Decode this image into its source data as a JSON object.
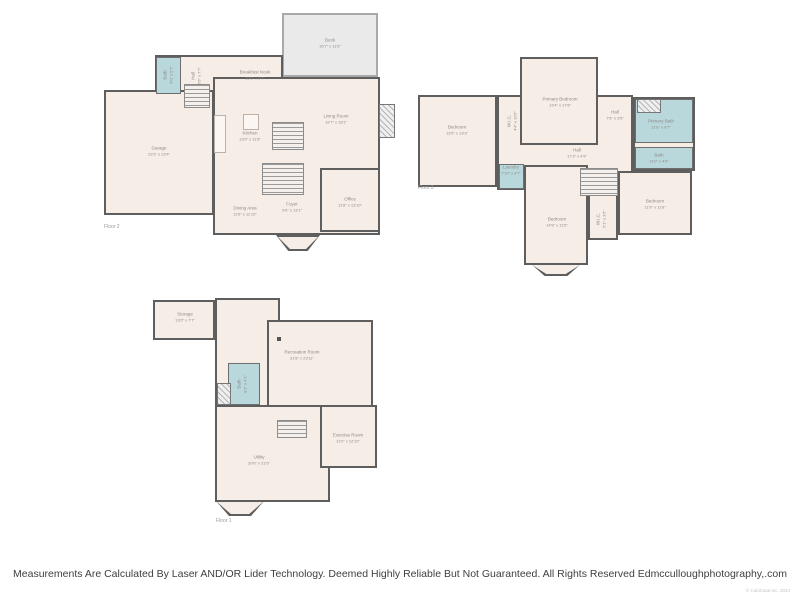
{
  "footer": {
    "disclaimer": "Measurements Are Calculated By Laser AND/OR Lider Technology. Deemed Highly Reliable But Not Guaranteed. All Rights Reserved Edmcculloughphotography,.com",
    "copyright": "© CubiCasa Inc, 2024"
  },
  "colors": {
    "room_fill": "#f7ede7",
    "deck_fill": "#eaeaea",
    "wet_room_fill": "#b9d8dc",
    "wall": "#5e5e5e",
    "label_text": "#8e8a87"
  },
  "floors": [
    {
      "id": "floor-2",
      "floor_label": "Floor 2",
      "floor_label_pos": {
        "x": 104,
        "y": 224
      },
      "shapes": [
        {
          "kind": "deck",
          "name": "deck-area",
          "x": 282,
          "y": 13,
          "w": 96,
          "h": 64
        },
        {
          "kind": "room",
          "name": "breakfast-hall-block",
          "x": 155,
          "y": 55,
          "w": 128,
          "h": 48
        },
        {
          "kind": "room",
          "name": "main-living-block",
          "x": 213,
          "y": 77,
          "w": 167,
          "h": 158
        },
        {
          "kind": "room",
          "name": "garage-room",
          "x": 104,
          "y": 90,
          "w": 110,
          "h": 125
        },
        {
          "kind": "wet",
          "name": "bath-room",
          "x": 156,
          "y": 57,
          "w": 25,
          "h": 37
        },
        {
          "kind": "room",
          "name": "office-room",
          "x": 320,
          "y": 168,
          "w": 60,
          "h": 64
        },
        {
          "kind": "hatch",
          "name": "fireplace",
          "x": 379,
          "y": 104,
          "w": 16,
          "h": 34
        },
        {
          "kind": "counter",
          "name": "kitchen-counter",
          "x": 214,
          "y": 115,
          "w": 12,
          "h": 38
        },
        {
          "kind": "counter",
          "name": "kitchen-island",
          "x": 243,
          "y": 114,
          "w": 16,
          "h": 16
        },
        {
          "kind": "stairs",
          "name": "stairs-upper",
          "x": 272,
          "y": 122,
          "w": 32,
          "h": 28
        },
        {
          "kind": "stairs",
          "name": "stairs-lower",
          "x": 262,
          "y": 163,
          "w": 42,
          "h": 32
        },
        {
          "kind": "stairs",
          "name": "entry-steps",
          "x": 184,
          "y": 84,
          "w": 26,
          "h": 24
        },
        {
          "kind": "bay",
          "name": "foyer-bay-window",
          "x": 276,
          "y": 235,
          "w": 44,
          "h": 16
        }
      ],
      "labels": [
        {
          "name": "deck",
          "text": "Deck",
          "dims": "16'7\" x 11'9\"",
          "x": 330,
          "y": 43,
          "vertical": false
        },
        {
          "name": "breakfast-nook",
          "text": "Breakfast Nook",
          "dims": "10'8\" x 9'7\"",
          "x": 255,
          "y": 75,
          "vertical": false
        },
        {
          "name": "living-room",
          "text": "Living Room",
          "dims": "19'7\" x 18'1\"",
          "x": 336,
          "y": 119,
          "vertical": false
        },
        {
          "name": "kitchen",
          "text": "Kitchen",
          "dims": "13'0\" x 11'8\"",
          "x": 250,
          "y": 136,
          "vertical": false
        },
        {
          "name": "garage",
          "text": "Garage",
          "dims": "23'3\" x 23'4\"",
          "x": 159,
          "y": 151,
          "vertical": false
        },
        {
          "name": "bath-f2",
          "text": "Bath",
          "dims": "6'0\" x 5'7\"",
          "x": 168,
          "y": 75,
          "vertical": true
        },
        {
          "name": "hall-f2",
          "text": "Hall",
          "dims": "3'6\" x 7'7\"",
          "x": 196,
          "y": 76,
          "vertical": true
        },
        {
          "name": "dining-area",
          "text": "Dining Area",
          "dims": "11'6\" x 11'10\"",
          "x": 245,
          "y": 211,
          "vertical": false
        },
        {
          "name": "foyer",
          "text": "Foyer",
          "dims": "9'6\" x 13'1\"",
          "x": 292,
          "y": 207,
          "vertical": false
        },
        {
          "name": "office",
          "text": "Office",
          "dims": "11'8\" x 13'10\"",
          "x": 350,
          "y": 202,
          "vertical": false
        }
      ]
    },
    {
      "id": "floor-3",
      "floor_label": "Floor 3",
      "floor_label_pos": {
        "x": 418,
        "y": 185
      },
      "shapes": [
        {
          "kind": "room",
          "name": "bedroom-left-room",
          "x": 418,
          "y": 95,
          "w": 79,
          "h": 92
        },
        {
          "kind": "room",
          "name": "center-hall-block",
          "x": 497,
          "y": 95,
          "w": 136,
          "h": 95
        },
        {
          "kind": "room",
          "name": "primary-bedroom-room",
          "x": 520,
          "y": 57,
          "w": 78,
          "h": 88
        },
        {
          "kind": "room",
          "name": "bath-block",
          "x": 633,
          "y": 97,
          "w": 62,
          "h": 74
        },
        {
          "kind": "room",
          "name": "bedroom-right-room",
          "x": 618,
          "y": 171,
          "w": 74,
          "h": 64
        },
        {
          "kind": "room",
          "name": "bedroom-bottom-room",
          "x": 524,
          "y": 165,
          "w": 64,
          "h": 100
        },
        {
          "kind": "room",
          "name": "wic-bottom-room",
          "x": 588,
          "y": 190,
          "w": 30,
          "h": 50
        },
        {
          "kind": "wet",
          "name": "primary-bath-room",
          "x": 635,
          "y": 99,
          "w": 58,
          "h": 44
        },
        {
          "kind": "wet",
          "name": "bath-room-f3",
          "x": 635,
          "y": 147,
          "w": 58,
          "h": 22
        },
        {
          "kind": "wet",
          "name": "laundry-room",
          "x": 499,
          "y": 164,
          "w": 25,
          "h": 25
        },
        {
          "kind": "hatch",
          "name": "shower",
          "x": 637,
          "y": 99,
          "w": 24,
          "h": 14
        },
        {
          "kind": "stairs",
          "name": "stairs-f3",
          "x": 580,
          "y": 168,
          "w": 38,
          "h": 28
        },
        {
          "kind": "bay",
          "name": "bedroom-bay-window",
          "x": 530,
          "y": 263,
          "w": 52,
          "h": 13
        }
      ],
      "labels": [
        {
          "name": "bedroom-left",
          "text": "Bedroom",
          "dims": "13'5\" x 13'3\"",
          "x": 457,
          "y": 130,
          "vertical": false
        },
        {
          "name": "wic-top",
          "text": "W.I.C.",
          "dims": "4'4\" x 10'5\"",
          "x": 512,
          "y": 121,
          "vertical": true
        },
        {
          "name": "primary-bedroom",
          "text": "Primary Bedroom",
          "dims": "13'4\" x 17'8\"",
          "x": 560,
          "y": 102,
          "vertical": false
        },
        {
          "name": "hall-small",
          "text": "Hall",
          "dims": "7'6\" x 3'5\"",
          "x": 615,
          "y": 115,
          "vertical": false
        },
        {
          "name": "primary-bath",
          "text": "Primary Bath",
          "dims": "11'8\" x 9'7\"",
          "x": 661,
          "y": 124,
          "vertical": false
        },
        {
          "name": "bath-f3",
          "text": "Bath",
          "dims": "11'0\" x 4'9\"",
          "x": 659,
          "y": 158,
          "vertical": false
        },
        {
          "name": "hall-long",
          "text": "Hall",
          "dims": "17'3\" x 4'9\"",
          "x": 577,
          "y": 153,
          "vertical": false
        },
        {
          "name": "laundry",
          "text": "Laundry",
          "dims": "7'10\" x 4'7\"",
          "x": 511,
          "y": 170,
          "vertical": false
        },
        {
          "name": "bedroom-bottom",
          "text": "Bedroom",
          "dims": "14'8\" x 11'5\"",
          "x": 557,
          "y": 222,
          "vertical": false
        },
        {
          "name": "wic-bottom",
          "text": "W.I.C.",
          "dims": "6'1\" x 3'5\"",
          "x": 601,
          "y": 219,
          "vertical": true
        },
        {
          "name": "bedroom-right",
          "text": "Bedroom",
          "dims": "11'9\" x 11'8\"",
          "x": 655,
          "y": 204,
          "vertical": false
        }
      ]
    },
    {
      "id": "floor-1",
      "floor_label": "Floor 1",
      "floor_label_pos": {
        "x": 216,
        "y": 518
      },
      "shapes": [
        {
          "kind": "room",
          "name": "storage-room",
          "x": 153,
          "y": 300,
          "w": 62,
          "h": 40
        },
        {
          "kind": "room",
          "name": "rec-left-block",
          "x": 215,
          "y": 298,
          "w": 65,
          "h": 204
        },
        {
          "kind": "room",
          "name": "rec-right-block",
          "x": 267,
          "y": 320,
          "w": 106,
          "h": 110
        },
        {
          "kind": "room",
          "name": "utility-room",
          "x": 215,
          "y": 405,
          "w": 115,
          "h": 97
        },
        {
          "kind": "room",
          "name": "exercise-room",
          "x": 320,
          "y": 405,
          "w": 57,
          "h": 63
        },
        {
          "kind": "wet",
          "name": "bath-room-f1",
          "x": 228,
          "y": 363,
          "w": 32,
          "h": 42
        },
        {
          "kind": "hatch",
          "name": "mechanical-closet",
          "x": 217,
          "y": 383,
          "w": 14,
          "h": 22
        },
        {
          "kind": "stairs",
          "name": "stairs-f1",
          "x": 277,
          "y": 420,
          "w": 30,
          "h": 18
        },
        {
          "kind": "dot",
          "name": "support-column",
          "x": 277,
          "y": 337,
          "w": 4,
          "h": 4
        },
        {
          "kind": "bay",
          "name": "utility-bay-window",
          "x": 215,
          "y": 500,
          "w": 50,
          "h": 16
        }
      ],
      "labels": [
        {
          "name": "storage",
          "text": "Storage",
          "dims": "13'0\" x 7'7\"",
          "x": 185,
          "y": 317,
          "vertical": false
        },
        {
          "name": "recreation-room",
          "text": "Recreation Room",
          "dims": "31'8\" x 23'11\"",
          "x": 302,
          "y": 355,
          "vertical": false
        },
        {
          "name": "bath-f1",
          "text": "Bath",
          "dims": "8'1\" x 4'1\"",
          "x": 242,
          "y": 384,
          "vertical": true
        },
        {
          "name": "exercise-room",
          "text": "Exercise Room",
          "dims": "11'0\" x 12'10\"",
          "x": 348,
          "y": 438,
          "vertical": false
        },
        {
          "name": "utility",
          "text": "Utility",
          "dims": "20'6\" x 21'6\"",
          "x": 259,
          "y": 460,
          "vertical": false
        }
      ]
    }
  ]
}
